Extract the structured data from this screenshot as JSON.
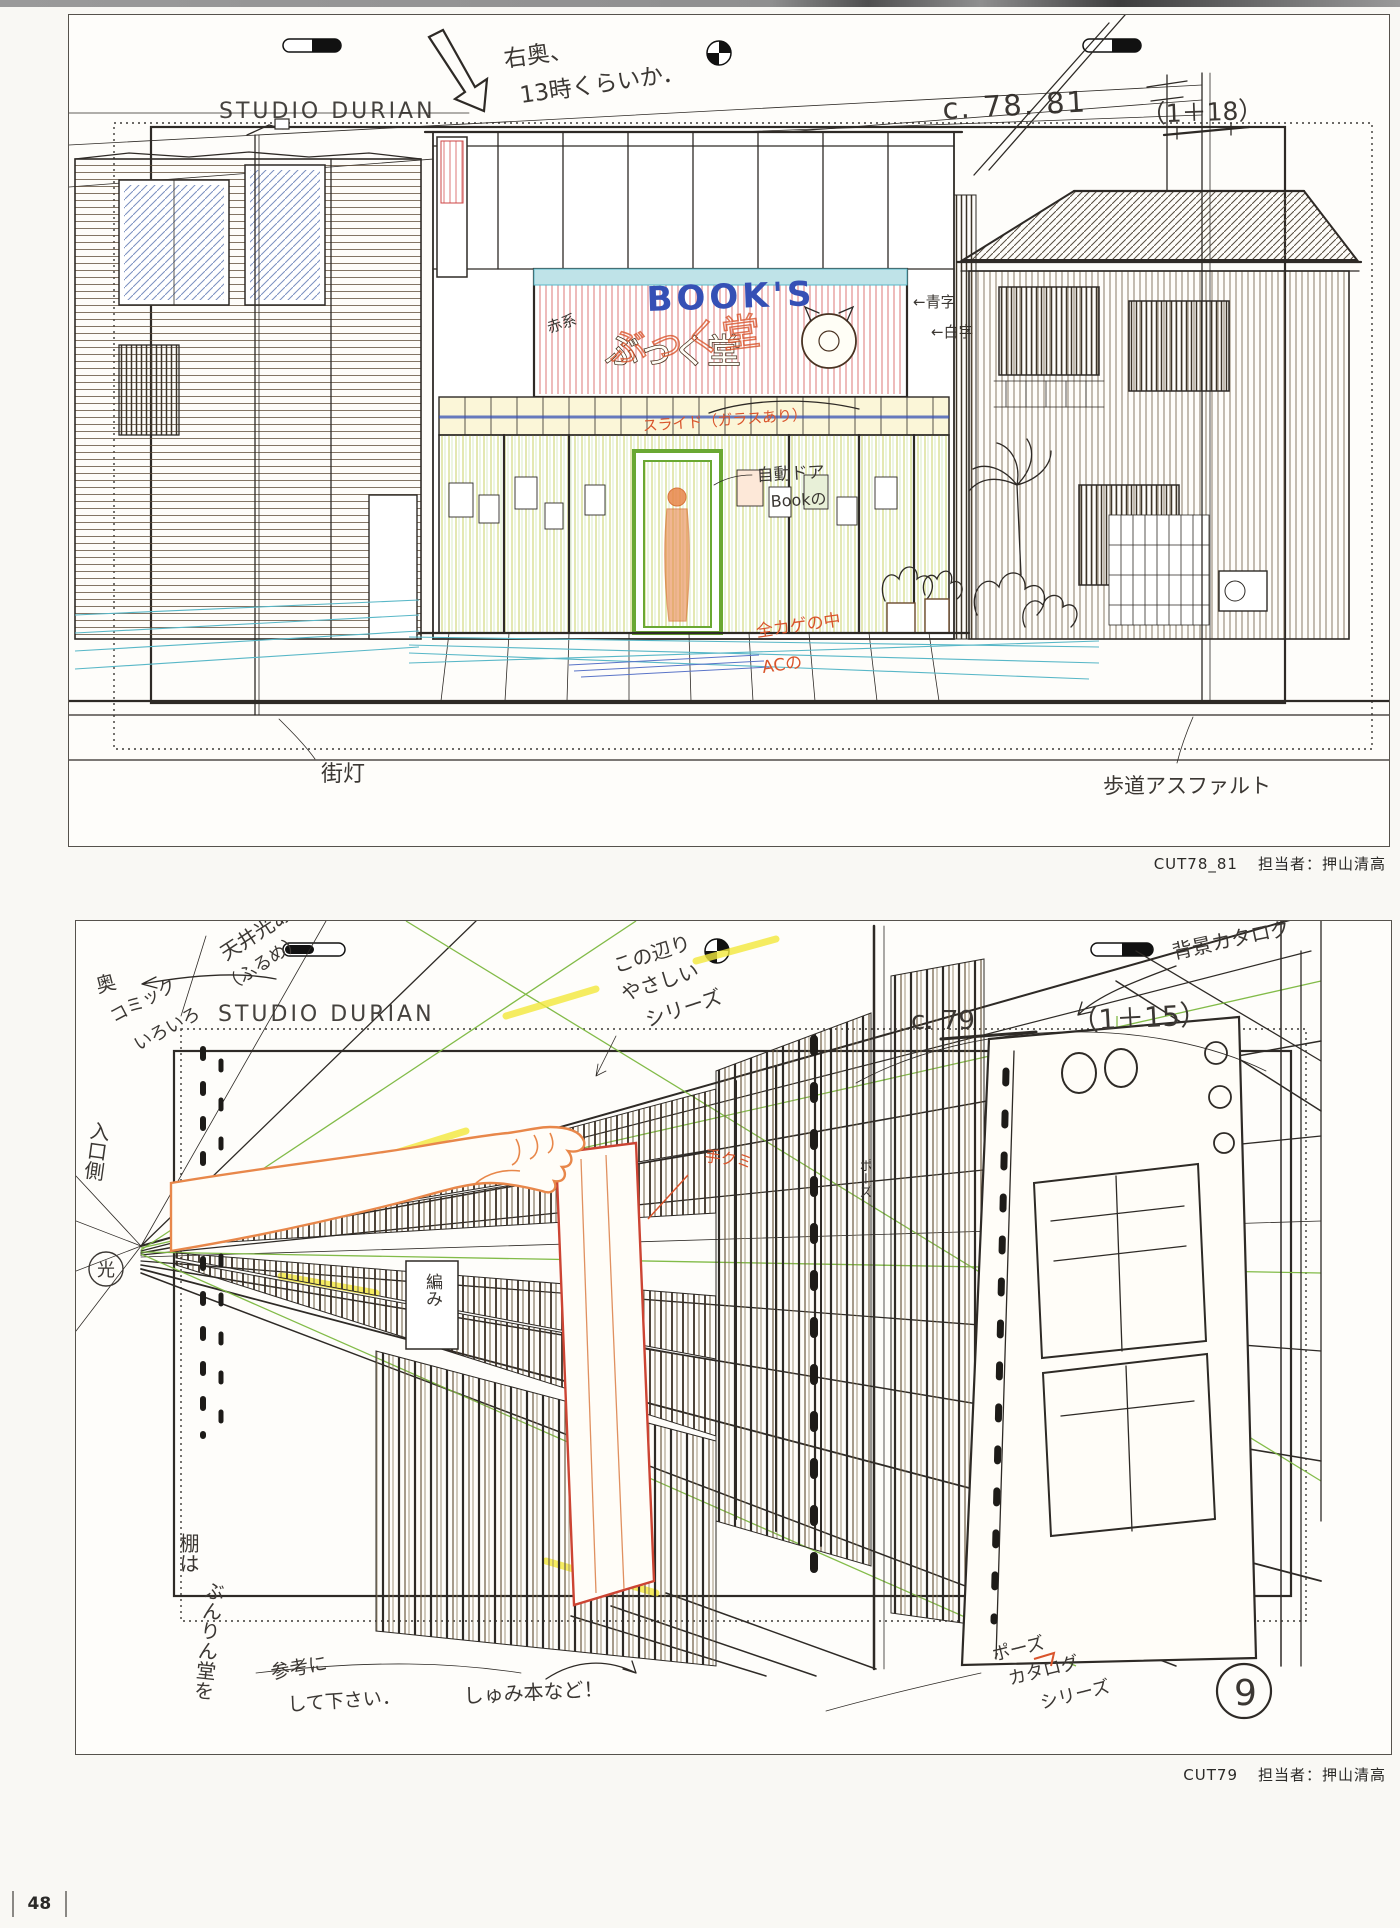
{
  "page": {
    "number": "48"
  },
  "colors": {
    "line": "#2e2a26",
    "blue_pen": "#3550b5",
    "red_pencil": "#d9542b",
    "orange_pencil": "#e8874a",
    "green_guide": "#7cb83f",
    "yellow_marker": "#f3e93c",
    "teal_pencil": "#58b7c7",
    "green_frame": "#6aa832"
  },
  "panel1": {
    "header": "STUDIO DURIAN",
    "cut_number": "c. 78. 81",
    "frame_count": "（1＋18）",
    "sign": {
      "latin": "BOOK'S",
      "kana": "ぶっく堂",
      "scribble": "ぶっく堂"
    },
    "notes": {
      "top_1": "右奥、",
      "top_2": "13時くらいか．",
      "sign_color": "赤系",
      "blue_text": "←青字",
      "white_text": "←白字",
      "slide": "スライド（ガラスあり）",
      "auto_door": "自動ドア",
      "auto_door_2": "Bookの",
      "shade_1": "全カゲの中",
      "shade_2": "ACの",
      "street_lamp": "街灯",
      "sidewalk": "歩道アスファルト"
    },
    "caption": {
      "cut": "CUT78_81",
      "staff": "担当者：押山清高"
    }
  },
  "panel2": {
    "header": "STUDIO DURIAN",
    "cut_number": "c. 79",
    "frame_count": "（1＋15）",
    "notes": {
      "ceiling_1": "天井光あり",
      "ceiling_2": "（ふるめ）",
      "back": "奥",
      "comic_1": "コミック",
      "comic_2": "いろいろ",
      "area_1": "この辺り",
      "area_2": "やさしい",
      "area_3": "シリーズ",
      "bg_catalog": "背景カタログ",
      "entrance": "入口側",
      "entrance_light": "光",
      "shelf_1": "棚は",
      "shelf_2": "ぶんりん堂を",
      "shelf_3": "参考に",
      "shelf_4": "して下さい．",
      "hobby": "しゅみ本など！",
      "hand": "手クミ",
      "pose_1": "ポーズ",
      "pose_2": "カタログ",
      "pose_3": "シリーズ",
      "spine": "ポーズ",
      "cover": "編み",
      "circle_number": "9"
    },
    "caption": {
      "cut": "CUT79",
      "staff": "担当者：押山清高"
    }
  }
}
